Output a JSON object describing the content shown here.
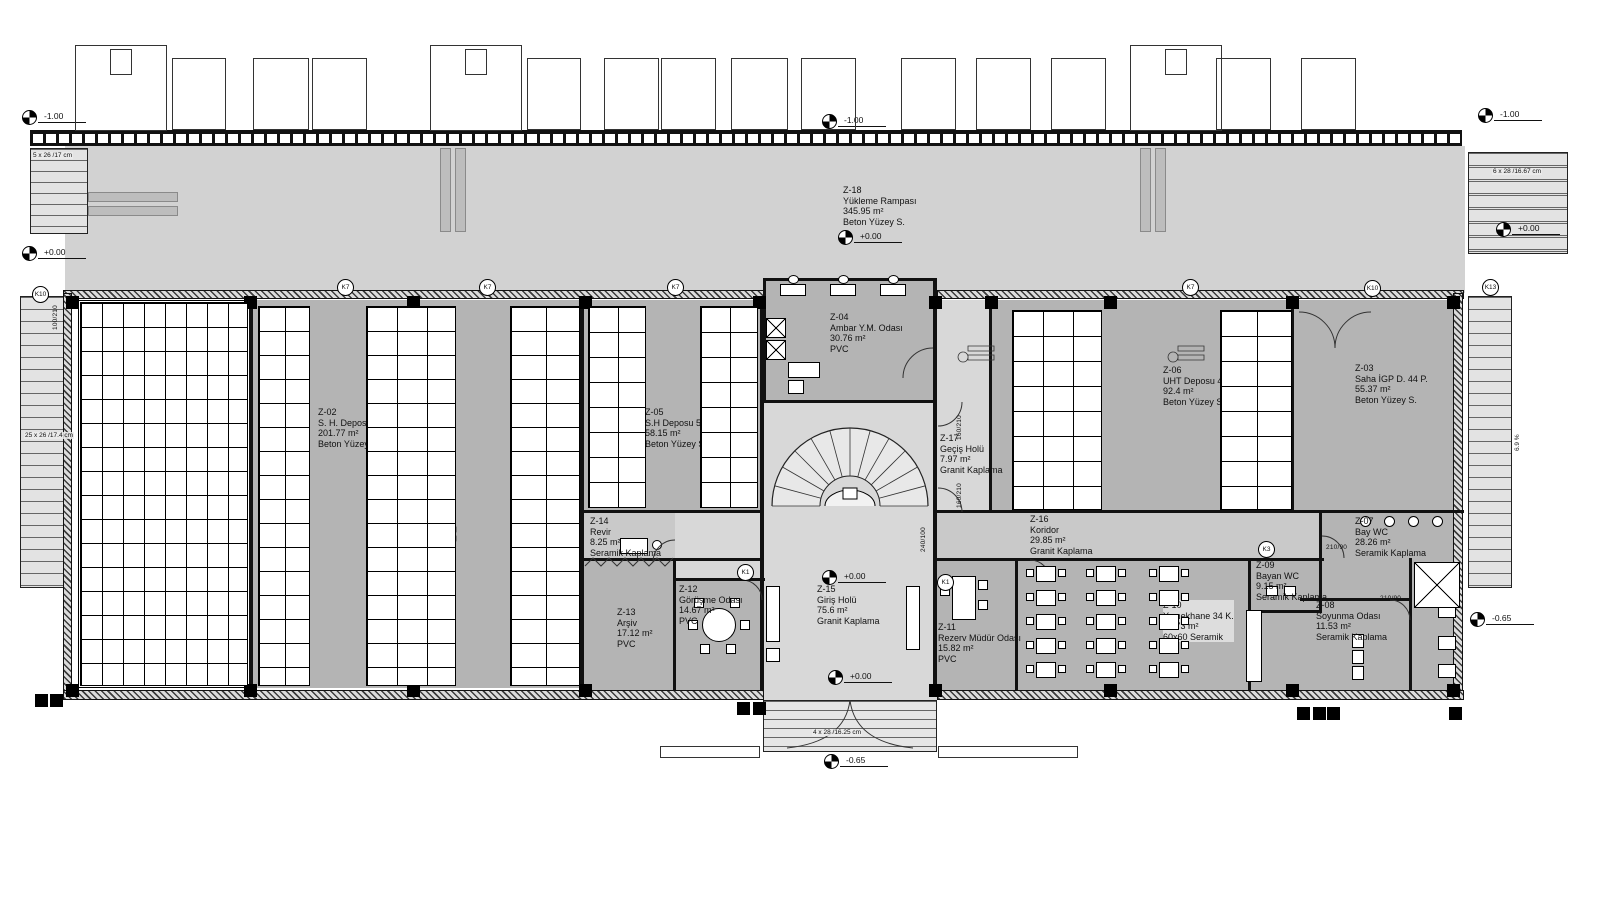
{
  "rooms": [
    {
      "id": "Z-01",
      "name": "Depozito 102 Palet",
      "area": "113.84 m²",
      "floor": "Beton Yüzey S."
    },
    {
      "id": "Z-02",
      "name": "S. H. Deposu 112 P.",
      "area": "201.77 m²",
      "floor": "Beton Yüzey S."
    },
    {
      "id": "Z-03",
      "name": "Saha İGP D. 44 P.",
      "area": "55.37 m²",
      "floor": "Beton Yüzey S."
    },
    {
      "id": "Z-04",
      "name": "Ambar Y.M. Odası",
      "area": "30.76 m²",
      "floor": "PVC"
    },
    {
      "id": "Z-05",
      "name": "S.H Deposu 56 P.",
      "area": "58.15 m²",
      "floor": "Beton Yüzey S."
    },
    {
      "id": "Z-06",
      "name": "UHT Deposu 44 pl.",
      "area": "92.4 m²",
      "floor": "Beton Yüzey S."
    },
    {
      "id": "Z-07",
      "name": "Bay WC",
      "area": "28.26 m²",
      "floor": "Seramik Kaplama"
    },
    {
      "id": "Z-08",
      "name": "Soyunma Odası",
      "area": "11.53 m²",
      "floor": "Seramik Kaplama"
    },
    {
      "id": "Z-09",
      "name": "Bayan WC",
      "area": "9.15 m²",
      "floor": "Seramik Kaplama"
    },
    {
      "id": "Z-10",
      "name": "Yemekhane 34 K.",
      "area": "53.73 m²",
      "floor": "60x60 Seramik"
    },
    {
      "id": "Z-11",
      "name": "Rezerv Müdür Odası",
      "area": "15.82 m²",
      "floor": "PVC"
    },
    {
      "id": "Z-12",
      "name": "Görüşme Odası",
      "area": "14.67 m²",
      "floor": "PVC"
    },
    {
      "id": "Z-13",
      "name": "Arşiv",
      "area": "17.12 m²",
      "floor": "PVC"
    },
    {
      "id": "Z-14",
      "name": "Revir",
      "area": "8.25 m²",
      "floor": "Seramik Kaplama"
    },
    {
      "id": "Z-15",
      "name": "Giriş Holü",
      "area": "75.6 m²",
      "floor": "Granit Kaplama"
    },
    {
      "id": "Z-16",
      "name": "Koridor",
      "area": "29.85 m²",
      "floor": "Granit Kaplama"
    },
    {
      "id": "Z-17",
      "name": "Geçiş Holü",
      "area": "7.97 m²",
      "floor": "Granit Kaplama"
    },
    {
      "id": "Z-18",
      "name": "Yükleme Rampası",
      "area": "345.95 m²",
      "floor": "Beton Yüzey S."
    }
  ],
  "levels": [
    {
      "value": "-1.00"
    },
    {
      "value": "-1.00"
    },
    {
      "value": "-1.00"
    },
    {
      "value": "+0.00"
    },
    {
      "value": "+0.00"
    },
    {
      "value": "+0.00"
    },
    {
      "value": "+0.00"
    },
    {
      "value": "+0.00"
    },
    {
      "value": "-0.65"
    },
    {
      "value": "-0.65"
    }
  ],
  "notes": {
    "left_ramp_stair": "5 x 26 /17 cm",
    "right_ramp_stair": "6 x 28 /16.67 cm",
    "left_side_stair": "25 x 26 /17.4 cm",
    "entrance_stair": "4 x 28 /16.25 cm",
    "slope": "6.9 %"
  },
  "grid_bubbles": [
    {
      "label": "K10"
    },
    {
      "label": "K7"
    },
    {
      "label": "K7"
    },
    {
      "label": "K7"
    },
    {
      "label": "K7"
    },
    {
      "label": "K10"
    },
    {
      "label": "K13"
    },
    {
      "label": "K1"
    },
    {
      "label": "K1"
    },
    {
      "label": "K3"
    }
  ],
  "door_tags": [
    {
      "label": "100/210"
    },
    {
      "label": "160/210"
    },
    {
      "label": "160/210"
    },
    {
      "label": "240/100"
    },
    {
      "label": "210/90"
    },
    {
      "label": "210/90"
    }
  ],
  "colors": {
    "wall": "#111111",
    "room_gray": "#b4b4b4",
    "hall_gray": "#d8d8d8",
    "ramp_gray": "#d2d2d2"
  }
}
